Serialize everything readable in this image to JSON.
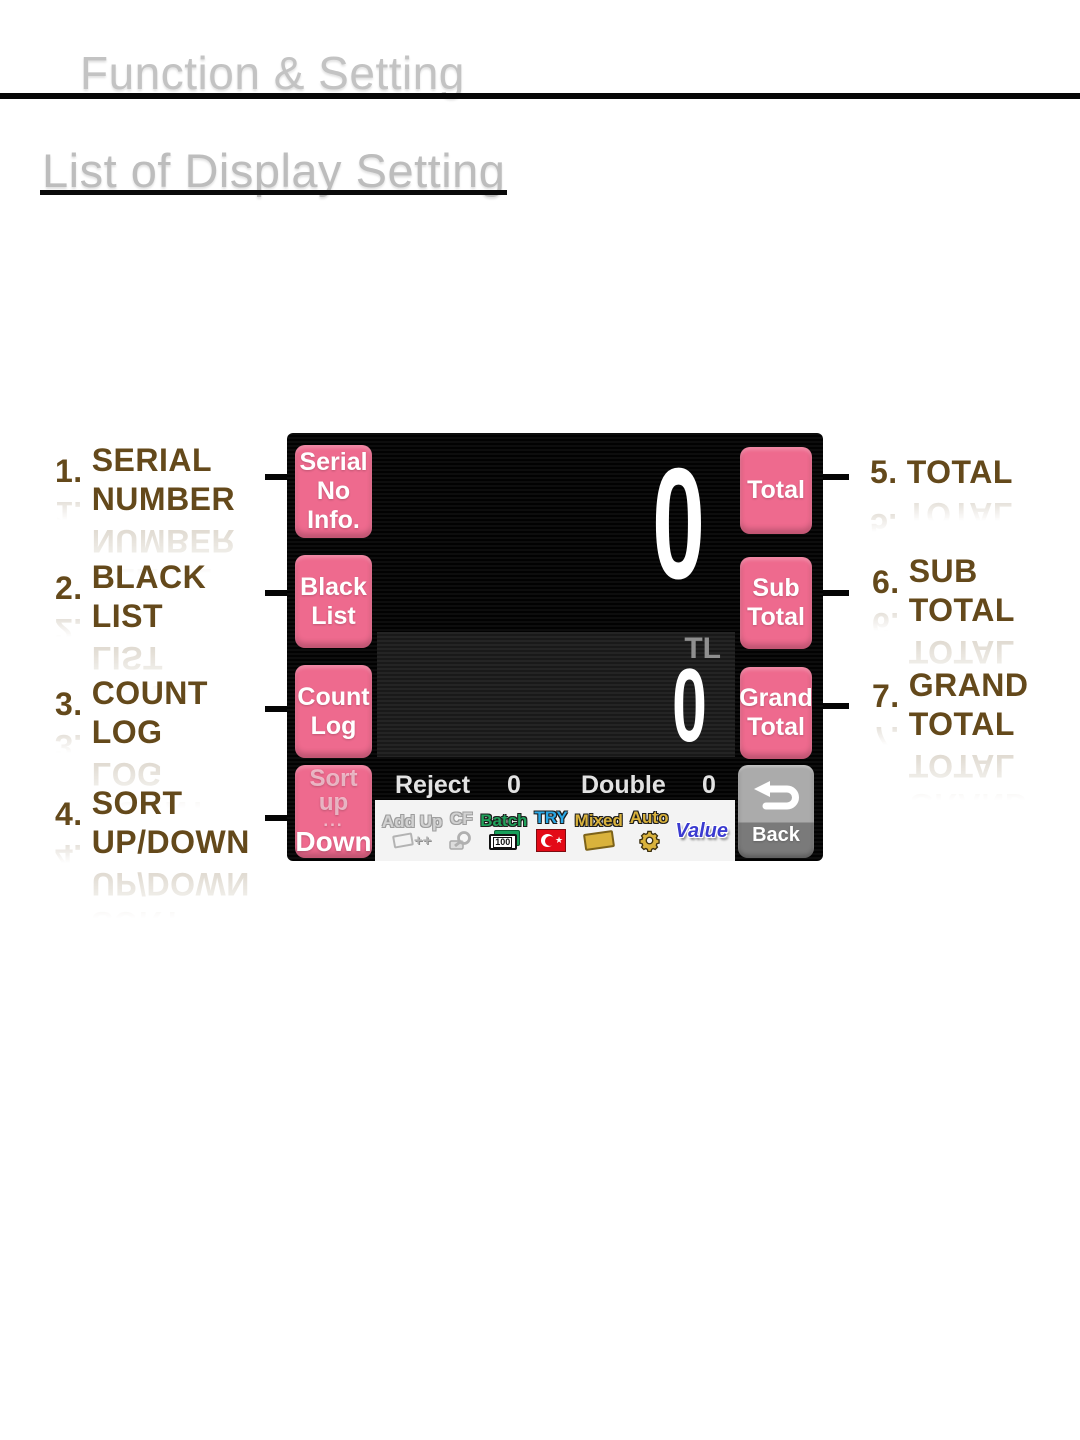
{
  "page": {
    "header_title": "Function & Setting",
    "section_title": "List of Display Setting"
  },
  "annotations": {
    "left": [
      {
        "number": "1.",
        "line1": "SERIAL",
        "line2": "NUMBER"
      },
      {
        "number": "2.",
        "line1": "BLACK",
        "line2": "LIST"
      },
      {
        "number": "3.",
        "line1": "COUNT",
        "line2": "LOG"
      },
      {
        "number": "4.",
        "line1": "SORT",
        "line2": "UP/DOWN"
      }
    ],
    "right": [
      {
        "number": "5.",
        "line1": "TOTAL",
        "line2": ""
      },
      {
        "number": "6.",
        "line1": "SUB",
        "line2": "TOTAL"
      },
      {
        "number": "7.",
        "line1": "GRAND",
        "line2": "TOTAL"
      }
    ]
  },
  "device_screen": {
    "left_buttons": {
      "serial": {
        "line1": "Serial",
        "line2": "No Info."
      },
      "black_list": {
        "line1": "Black",
        "line2": "List"
      },
      "count_log": {
        "line1": "Count",
        "line2": "Log"
      },
      "sort": {
        "top": "Sort up",
        "dots": "...",
        "bottom": "Down"
      }
    },
    "right_buttons": {
      "total": {
        "line1": "Total"
      },
      "sub_total": {
        "line1": "Sub",
        "line2": "Total"
      },
      "grand_total": {
        "line1": "Grand",
        "line2": "Total"
      },
      "back": {
        "label": "Back"
      }
    },
    "display": {
      "count_value": "0",
      "currency_code": "TL",
      "amount_value": "0",
      "reject_label": "Reject",
      "reject_value": "0",
      "double_label": "Double",
      "double_value": "0"
    },
    "mode_bar": {
      "add_up": {
        "label": "Add Up"
      },
      "cf": {
        "label": "CF"
      },
      "batch": {
        "label": "Batch",
        "badge": "100"
      },
      "try": {
        "label": "TRY"
      },
      "mixed": {
        "label": "Mixed"
      },
      "auto": {
        "label": "Auto"
      },
      "value": {
        "label": "Value"
      }
    },
    "colors": {
      "button_pink": "#ee6a8e",
      "back_gray": "#ababab",
      "screen_black": "#0d0d0d",
      "batch_green": "#1fa15a",
      "try_blue": "#2aa7e6",
      "flag_red": "#e30a17",
      "gold": "#d9b23c",
      "value_blue": "#3b3bd0",
      "disabled_gray": "#d2d2d2",
      "annotation_brown": "#64491b"
    }
  }
}
